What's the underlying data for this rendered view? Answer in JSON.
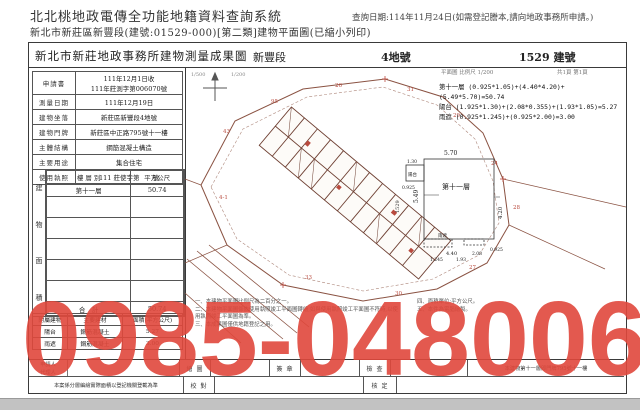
{
  "page": {
    "system_title": "北北桃地政電傳全功能地籍資料查詢系統",
    "query_date": "查詢日期:114年11月24日(如需登記謄本,請向地政事務所申請。)",
    "subtitle": "新北市新莊區新豐段(建號:01529-000)[第二類]建物平面圖(已縮小列印)"
  },
  "doc": {
    "title": "新北市新莊地政事務所建物測量成果圖",
    "section": "新豐段",
    "parcel": "4地號",
    "building_no": "1529 建號",
    "caption": "平面圖 比例尺 1/200",
    "page_no": "共1頁 第1頁"
  },
  "fields": [
    {
      "label": "申請書",
      "value": "111年12月1日收",
      "value2": "111年莊測字第006070號"
    },
    {
      "label": "測量日期",
      "value": "111年12月19日"
    },
    {
      "label": "建物坐落",
      "value": "新莊區新豐段4地號"
    },
    {
      "label": "建物門牌",
      "value": "新莊區中正路795號十一樓"
    },
    {
      "label": "主體結構",
      "value": "鋼筋混凝土構造"
    },
    {
      "label": "主要用途",
      "value": "集合住宅"
    },
    {
      "label": "使用執照",
      "value": "111 莊使字第　　號"
    }
  ],
  "floor_table": {
    "side_label": [
      "建",
      "物",
      "面",
      "積"
    ],
    "col_floor": "樓 層 別",
    "col_area": "平方公尺",
    "row_floor": "第十一層",
    "row_area": "50.74",
    "total_label": "合　計",
    "total": "50.74"
  },
  "annex_table": {
    "h0": "附屬建物",
    "h1": "主要建材",
    "h2": "面積(平方公尺)",
    "r0": [
      "陽台",
      "鋼筋混凝土",
      "5.27"
    ],
    "r1": [
      "雨遮",
      "鋼筋混凝土",
      "3.00"
    ]
  },
  "formulas": [
    "第十一層 (0.925*1.05)+(4.40*4.20)+(5.49*5.70)=50.74",
    "陽台 (1.925*1.30)+(2.08*0.355)+(1.93*1.05)=5.27",
    "雨遮 (0.925*1.245)+(0.925*2.00)=3.00"
  ],
  "site_plan": {
    "scales": [
      "1/500",
      "1/200"
    ],
    "labels": [
      "43",
      "95",
      "26",
      "31",
      "29",
      "24",
      "28",
      "4-1",
      "33",
      "30",
      "27"
    ]
  },
  "detail_plan": {
    "room_label": "第十一層",
    "bno": "1529",
    "dims": {
      "top": "5.70",
      "left": "5.49",
      "right": "4.20",
      "w1": "4.40",
      "w2": "1.93",
      "w3": "2.08",
      "w4": "1.245",
      "w5": "0.925",
      "w6": "0.925",
      "balcony_w": "1.30",
      "balcony": "陽台",
      "canopy": "雨遮"
    }
  },
  "notes": [
    "一、本建物平面圖比例尺為二百分之一。",
    "二、本建物平面圖係依使用執照竣工平面圖轉繪,如與使用執照竣工平面圖不符時,以使用執照竣工平面圖為準。",
    "三、本成果圖僅供地籍登記之用。",
    "四、面積單位:平方公尺。",
    "五、本件為電腦繪製。"
  ],
  "footer": {
    "applicant": "申請人",
    "agent": "代理人",
    "draw": "繪 圖",
    "sign": "簽 章",
    "check": "檢 查",
    "row1_note": "本建物第十一層即門牌795號十一樓",
    "row2_note": "本案係分層編繪實際面積以登記機關登載為準",
    "proof": "校 對",
    "approve": "核 定"
  },
  "watermark": "0985-048006",
  "colors": {
    "watermark": "#e0483c",
    "plan_line": "#8a5242",
    "red_label": "#b94a3e"
  }
}
